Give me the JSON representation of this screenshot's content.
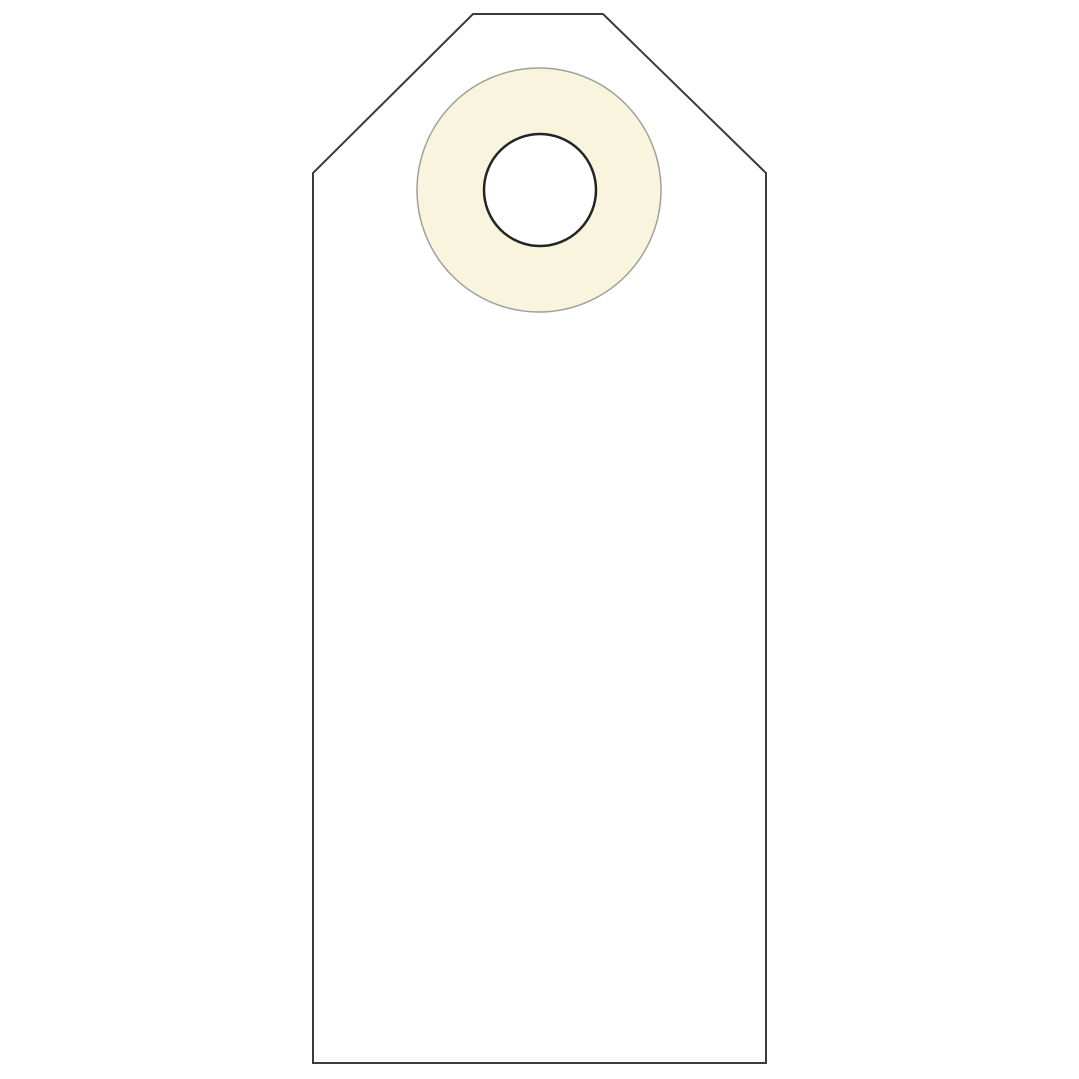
{
  "image": {
    "subject": "Blank white shipping tag with reinforced eyelet hole",
    "viewbox": "0 0 1079 1079",
    "colors": {
      "background": "#ffffff",
      "tag_fill": "#ffffff",
      "tag_outline": "#3b3b3b",
      "ring_fill": "#f8f4dd",
      "ring_outline": "#a0a099",
      "hole_fill": "#ffffff",
      "hole_outline": "#252525"
    },
    "tag": {
      "points": "473,14 603,14 766,173 766,1063 313,1063 313,173",
      "stroke_width": "2"
    },
    "ring": {
      "cx": "539",
      "cy": "190",
      "r": "122",
      "stroke_width": "1.5"
    },
    "hole": {
      "cx": "540",
      "cy": "190",
      "r": "56",
      "stroke_width": "2.5"
    }
  }
}
